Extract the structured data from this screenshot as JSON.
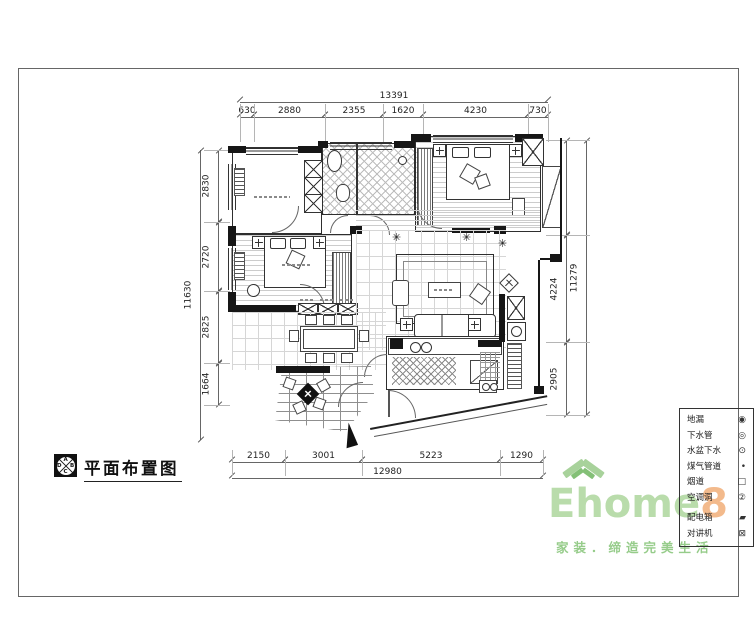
{
  "sheet": {
    "title": "平面布置图",
    "logo_letters": {
      "top": "A",
      "right": "B",
      "bottom": "C",
      "left": "D"
    }
  },
  "dimensions": {
    "top": {
      "total": "13391",
      "segments": [
        "630",
        "2880",
        "2355",
        "1620",
        "4230",
        "730"
      ]
    },
    "bottom": {
      "total": "12980",
      "segments": [
        "2150",
        "3001",
        "5223",
        "1290"
      ]
    },
    "left": {
      "total": "11630",
      "segments": [
        "2830",
        "2720",
        "2825",
        "1664"
      ]
    },
    "right": {
      "total": "11279",
      "segments": [
        "3705",
        "4224",
        "2905"
      ]
    }
  },
  "legend": {
    "items": [
      {
        "label": "地漏",
        "symbol": "◉"
      },
      {
        "label": "下水管",
        "symbol": "◎"
      },
      {
        "label": "水盆下水",
        "symbol": "⊙"
      },
      {
        "label": "煤气管道",
        "symbol": "•"
      },
      {
        "label": "烟道",
        "symbol": "□"
      },
      {
        "label": "空调洞",
        "symbol": "②"
      },
      {
        "label": "配电箱",
        "symbol": "▰"
      },
      {
        "label": "对讲机",
        "symbol": "⊠"
      }
    ]
  },
  "watermark": {
    "brand": "Ehome",
    "brand_number": "8",
    "slogan": "家装．缔造完美生活",
    "colors": {
      "green": "#b9dcab",
      "orange": "#f3ba8c"
    }
  },
  "icons": {
    "plant": "✳"
  }
}
